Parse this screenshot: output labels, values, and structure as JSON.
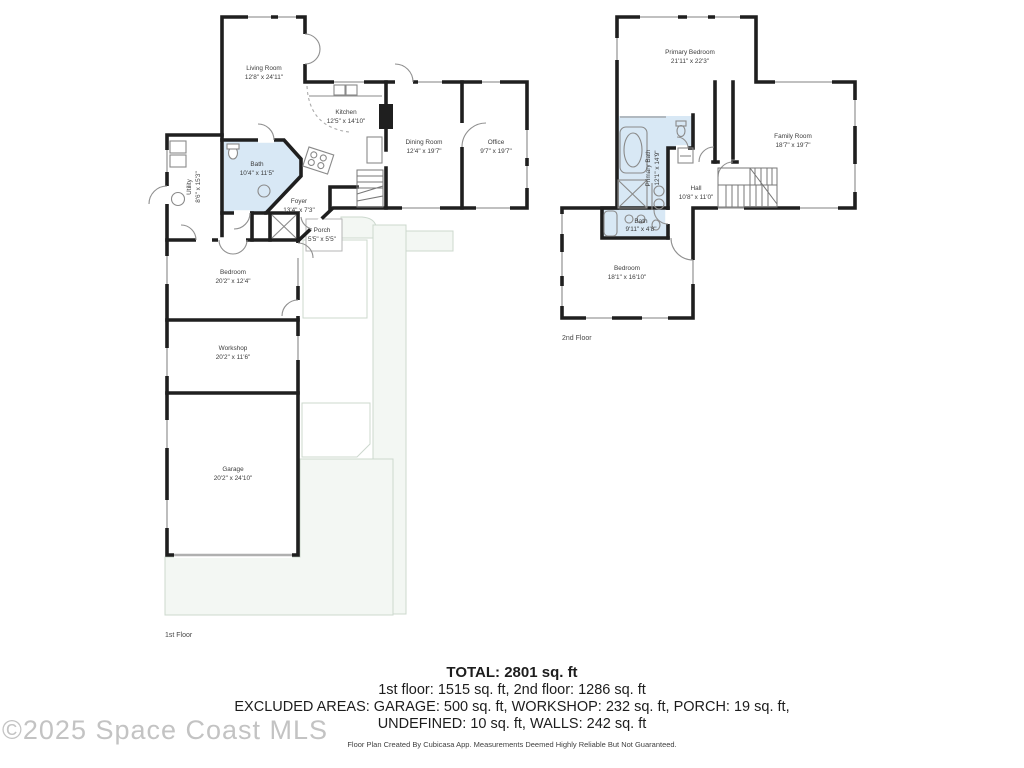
{
  "floor1": {
    "label": "1st Floor",
    "rooms": {
      "living": {
        "name": "Living Room",
        "dims": "12'8\" x 24'11\""
      },
      "kitchen": {
        "name": "Kitchen",
        "dims": "12'5\" x 14'10\""
      },
      "dining": {
        "name": "Dining Room",
        "dims": "12'4\" x 19'7\""
      },
      "office": {
        "name": "Office",
        "dims": "9'7\" x 19'7\""
      },
      "bath": {
        "name": "Bath",
        "dims": "10'4\" x 11'5\""
      },
      "utility": {
        "name": "Utility",
        "dims": "8'6\" x 15'3\""
      },
      "foyer": {
        "name": "Foyer",
        "dims": "13'4\" x 7'3\""
      },
      "porch": {
        "name": "Porch",
        "dims": "5'5\" x 5'5\""
      },
      "bedroom": {
        "name": "Bedroom",
        "dims": "20'2\" x 12'4\""
      },
      "workshop": {
        "name": "Workshop",
        "dims": "20'2\" x 11'6\""
      },
      "garage": {
        "name": "Garage",
        "dims": "20'2\" x 24'10\""
      }
    }
  },
  "floor2": {
    "label": "2nd Floor",
    "rooms": {
      "primary_bedroom": {
        "name": "Primary Bedroom",
        "dims": "21'11\" x 22'3\""
      },
      "family_room": {
        "name": "Family Room",
        "dims": "18'7\" x 19'7\""
      },
      "primary_bath": {
        "name": "Primary Bath",
        "dims": "12'1\" x 14'9\""
      },
      "hall": {
        "name": "Hall",
        "dims": "10'8\" x 11'0\""
      },
      "bath": {
        "name": "Bath",
        "dims": "9'11\" x 4'8\""
      },
      "bedroom": {
        "name": "Bedroom",
        "dims": "18'1\" x 16'10\""
      }
    }
  },
  "summary": {
    "total": "TOTAL: 2801 sq. ft",
    "floors_line": "1st floor: 1515 sq. ft, 2nd floor: 1286 sq. ft",
    "excluded_line1": "EXCLUDED AREAS: GARAGE: 500 sq. ft, WORKSHOP: 232 sq. ft, PORCH: 19 sq. ft,",
    "excluded_line2": "UNDEFINED: 10 sq. ft, WALLS: 242 sq. ft",
    "disclaimer": "Floor Plan Created By Cubicasa App. Measurements Deemed Highly Reliable But Not Guaranteed."
  },
  "watermark": "©2025 Space Coast MLS",
  "colors": {
    "walls": "#1f1f1f",
    "bath_fill": "#d8e8f5",
    "outdoor_fill": "#f3f7f3",
    "outdoor_stroke": "#ccd8ce",
    "label_text": "#3c3c3c",
    "watermark": "#c3c3c3"
  }
}
